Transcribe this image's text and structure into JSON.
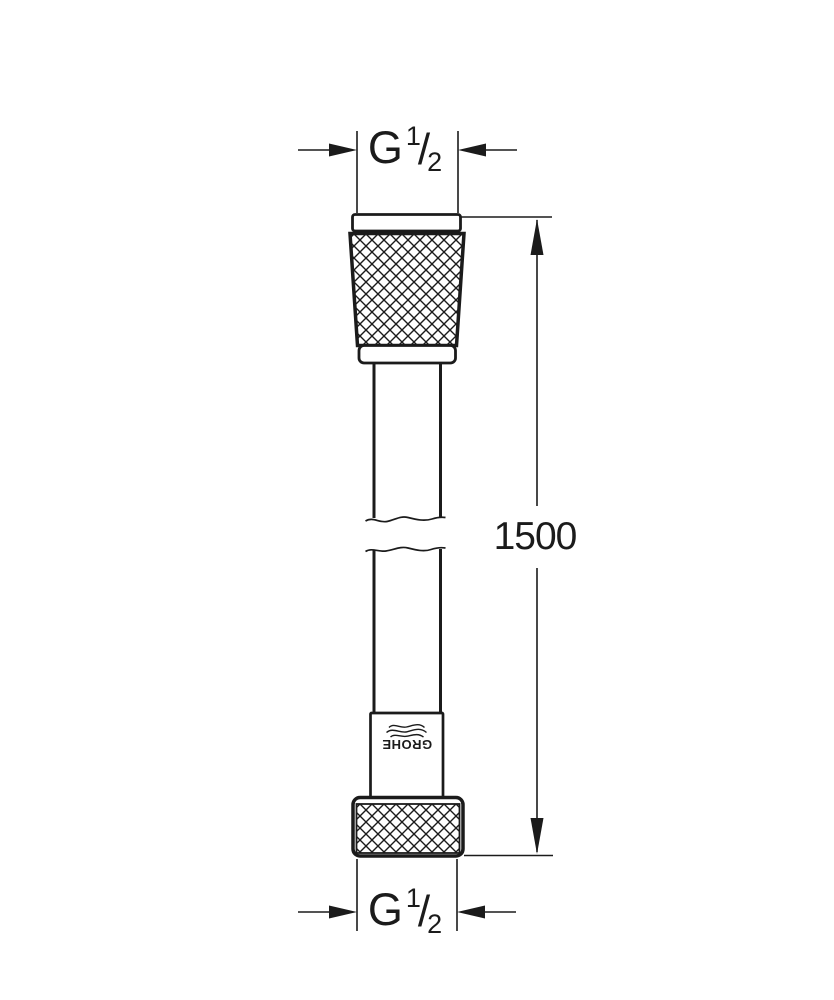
{
  "drawing": {
    "colors": {
      "line": "#1b1b1b",
      "background": "#ffffff"
    },
    "top_thread": {
      "symbol": "G",
      "numerator": "1",
      "slash": "/",
      "denominator": "2"
    },
    "bottom_thread": {
      "symbol": "G",
      "numerator": "1",
      "slash": "/",
      "denominator": "2"
    },
    "length_dimension": {
      "value": "1500"
    },
    "brand": {
      "text": "GROHE"
    }
  }
}
